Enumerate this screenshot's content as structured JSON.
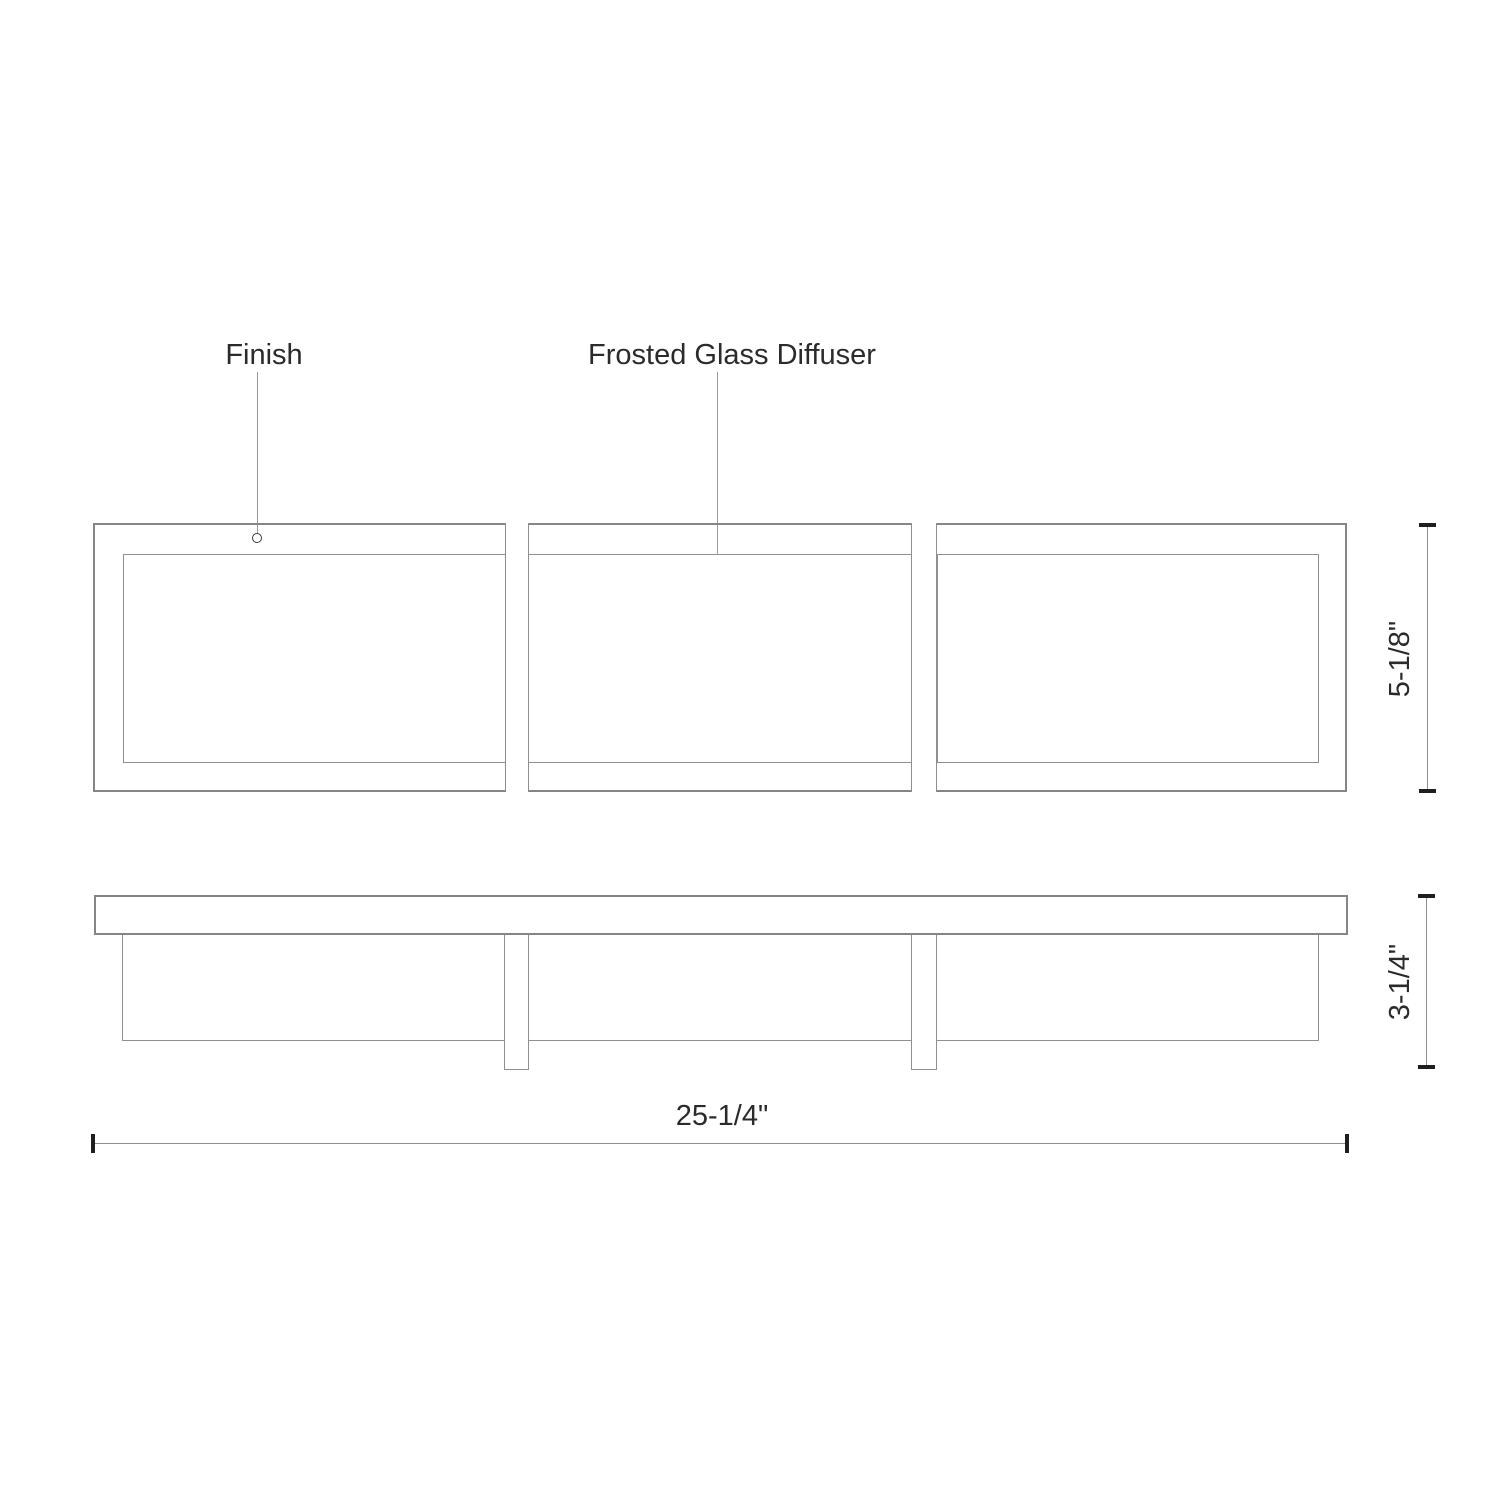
{
  "drawing": {
    "type": "product-dimension-diagram",
    "callouts": {
      "finish": "Finish",
      "diffuser": "Frosted Glass Diffuser"
    },
    "dimensions": {
      "fixture_height": "5-1/8\"",
      "fixture_depth": "3-1/4\"",
      "fixture_width": "25-1/4\""
    },
    "colors": {
      "background": "#ffffff",
      "drawing_line": "#8f8f8f",
      "frame_line": "#858585",
      "dimension_tick": "#1f1f1f",
      "text": "#2b2b2b"
    }
  }
}
